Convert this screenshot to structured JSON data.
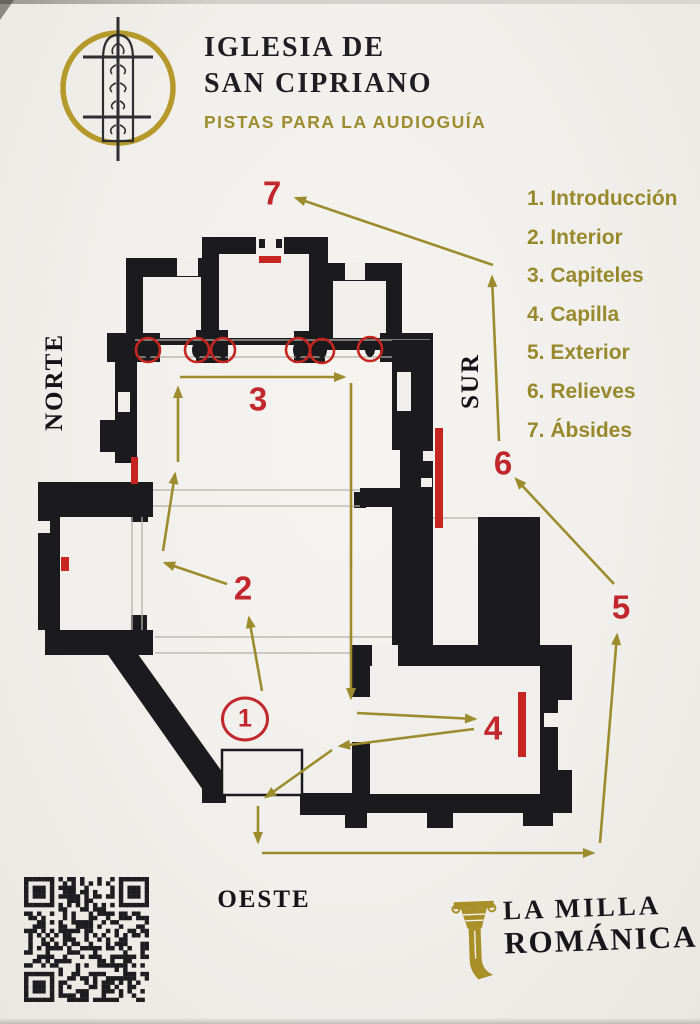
{
  "header": {
    "title_line1": "IGLESIA DE",
    "title_line2": "SAN CIPRIANO",
    "subtitle": "PISTAS PARA LA AUDIOGUÍA"
  },
  "legend": {
    "items": [
      "1. Introducción",
      "2. Interior",
      "3. Capiteles",
      "4. Capilla",
      "5. Exterior",
      "6. Relieves",
      "7. Ábsides"
    ]
  },
  "compass": {
    "north": "NORTE",
    "south": "SUR",
    "west": "OESTE"
  },
  "route_markers": {
    "m1": "1",
    "m2": "2",
    "m3": "3",
    "m4": "4",
    "m5": "5",
    "m6": "6",
    "m7": "7"
  },
  "brand": {
    "line1": "LA MILLA",
    "line2": "ROMÁNICA"
  },
  "icons": {
    "logo": "window-grille-icon",
    "qr": "qr-code",
    "brand": "column-capital-icon",
    "arrows": "route-arrow"
  },
  "colors": {
    "paper": "#f1efeb",
    "ink": "#1b1b1d",
    "olive": "#9c8c2e",
    "red": "#c6261f",
    "gold": "#b5992b"
  }
}
